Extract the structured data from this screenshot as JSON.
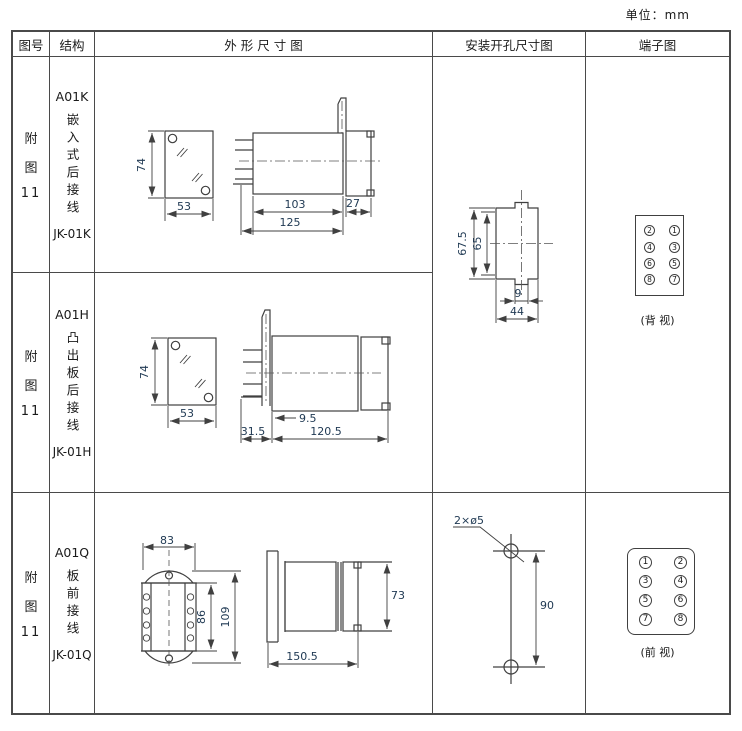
{
  "unit_label": "单位：mm",
  "colors": {
    "line": "#404040",
    "dim_text": "#1e3852",
    "text": "#1a1a1a"
  },
  "table": {
    "headers": {
      "figure_no": "图号",
      "structure": "结构",
      "outline": "外 形 尺 寸 图",
      "mounting": "安装开孔尺寸图",
      "terminal": "端子图"
    },
    "rows": [
      {
        "figure_no": {
          "l1": "附",
          "l2": "图",
          "l3": "11"
        },
        "structure": {
          "model": "A01K",
          "desc": "嵌入式后接线",
          "code": "JK-01K"
        },
        "dims": {
          "front_height": "74",
          "front_width": "53",
          "body_depth": "103",
          "front_depth": "27",
          "total_depth": "125"
        },
        "mounting": {
          "outer_height": "67.5",
          "inner_height": "65",
          "slot_width": "9",
          "width": "44"
        },
        "terminal": {
          "pins": [
            "2",
            "1",
            "4",
            "3",
            "6",
            "5",
            "8",
            "7"
          ],
          "view": "(背 视)"
        }
      },
      {
        "figure_no": {
          "l1": "附",
          "l2": "图",
          "l3": "11"
        },
        "structure": {
          "model": "A01H",
          "desc": "凸出板后接线",
          "code": "JK-01H"
        },
        "dims": {
          "front_height": "74",
          "front_width": "53",
          "panel_offset": "9.5",
          "front_depth": "31.5",
          "body_depth": "120.5"
        }
      },
      {
        "figure_no": {
          "l1": "附",
          "l2": "图",
          "l3": "11"
        },
        "structure": {
          "model": "A01Q",
          "desc": "板前接线",
          "code": "JK-01Q"
        },
        "dims": {
          "front_width": "83",
          "inner_height": "86",
          "outer_height": "109",
          "side_height": "73",
          "total_depth": "150.5"
        },
        "mounting": {
          "holes": "2×ø5",
          "spacing": "90"
        },
        "terminal": {
          "pins": [
            "1",
            "2",
            "3",
            "4",
            "5",
            "6",
            "7",
            "8"
          ],
          "view": "(前 视)"
        }
      }
    ]
  }
}
